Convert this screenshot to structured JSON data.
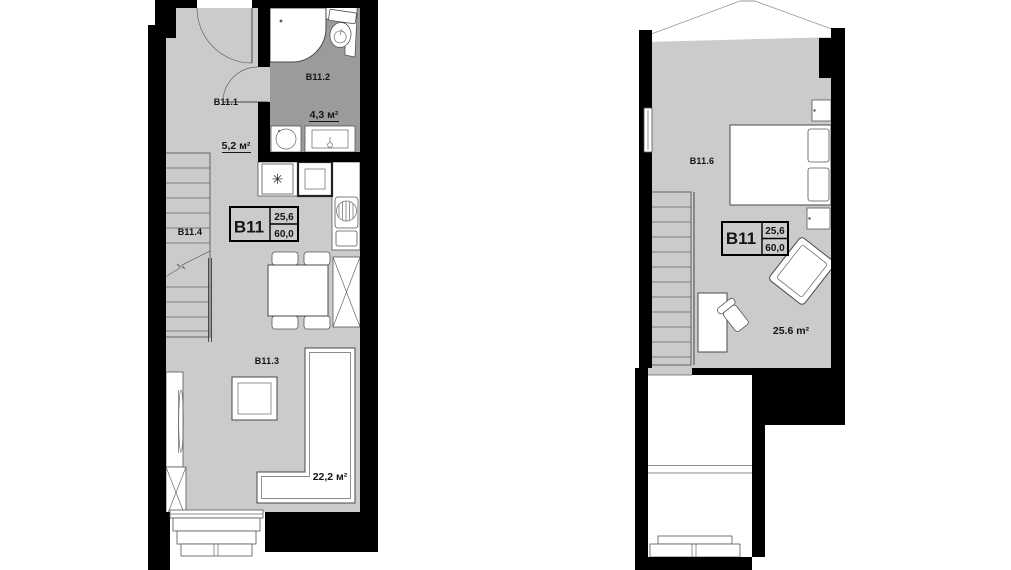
{
  "page": {
    "background": "#ffffff"
  },
  "palette": {
    "wall": "#000000",
    "floor": "#cbcbcb",
    "bathroom_floor": "#9b9b9b",
    "fixture_fill": "#ffffff",
    "fixture_outline": "#4a4a4a"
  },
  "unit_card": {
    "code": "B11",
    "area_value": "25,6",
    "total_value": "60,0"
  },
  "floors": {
    "lower": {
      "rooms": [
        {
          "id": "B11.1",
          "area": "5,2 м²"
        },
        {
          "id": "B11.2",
          "area": "4,3 м²"
        },
        {
          "id": "B11.3",
          "area": "22,2 м²"
        },
        {
          "id": "B11.4"
        }
      ]
    },
    "upper": {
      "rooms": [
        {
          "id": "B11.6",
          "area": "25.6 m²"
        }
      ]
    }
  },
  "symbols": {
    "stove_burner": "✳"
  }
}
